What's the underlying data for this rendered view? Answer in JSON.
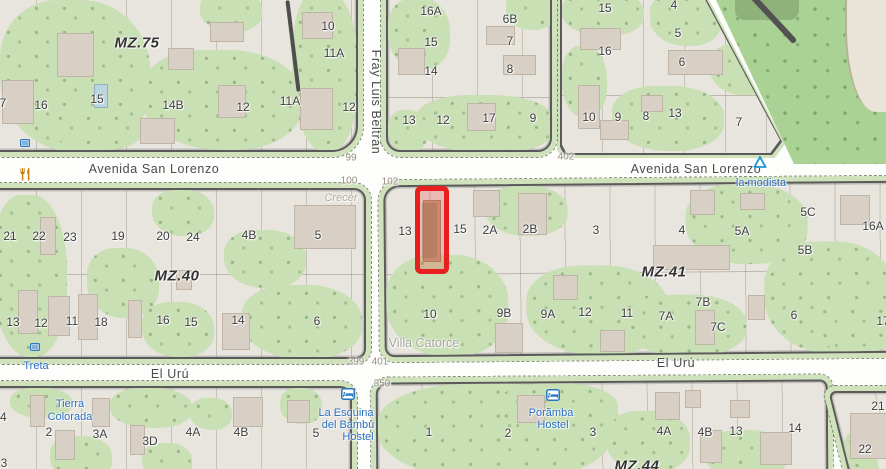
{
  "colors": {
    "highlight_red": "#e81f1f",
    "poi_blue": "#2a6fc0",
    "forest_green": "#abd295",
    "grass_green": "#c9dfb4",
    "block_base": "#e8e5de",
    "building": "#d9d0c5",
    "block_border": "#5a5a5a",
    "road_white": "#fdfdfb",
    "amenity_orange": "#c87d0e"
  },
  "map": {
    "mz_labels": [
      {
        "t": "MZ.75",
        "x": 137,
        "y": 43
      },
      {
        "t": "MZ.40",
        "x": 177,
        "y": 276
      },
      {
        "t": "MZ.41",
        "x": 664,
        "y": 272
      },
      {
        "t": "MZ.44",
        "x": 637,
        "y": 466
      }
    ],
    "street_labels": [
      {
        "t": "Avenida San Lorenzo",
        "x": 154,
        "y": 169
      },
      {
        "t": "Avenida San Lorenzo",
        "x": 696,
        "y": 169
      },
      {
        "t": "El Urú",
        "x": 170,
        "y": 374
      },
      {
        "t": "El Urú",
        "x": 676,
        "y": 363
      },
      {
        "t": "Fray Luis Beltrán",
        "x": 376,
        "y": 102,
        "vertical": true
      }
    ],
    "house_numbers": [
      {
        "t": "99",
        "x": 351,
        "y": 158
      },
      {
        "t": "100",
        "x": 349,
        "y": 181
      },
      {
        "t": "102",
        "x": 390,
        "y": 182
      },
      {
        "t": "402",
        "x": 566,
        "y": 157
      },
      {
        "t": "399",
        "x": 356,
        "y": 362
      },
      {
        "t": "401",
        "x": 380,
        "y": 362
      },
      {
        "t": "350",
        "x": 382,
        "y": 384
      }
    ],
    "lot_labels": [
      {
        "t": "10",
        "x": 328,
        "y": 26
      },
      {
        "t": "11A",
        "x": 334,
        "y": 53
      },
      {
        "t": "7",
        "x": 3,
        "y": 103
      },
      {
        "t": "16",
        "x": 41,
        "y": 105
      },
      {
        "t": "15",
        "x": 97,
        "y": 99
      },
      {
        "t": "14B",
        "x": 173,
        "y": 105
      },
      {
        "t": "12",
        "x": 243,
        "y": 107
      },
      {
        "t": "11A",
        "x": 290,
        "y": 101
      },
      {
        "t": "12",
        "x": 349,
        "y": 107
      },
      {
        "t": "16A",
        "x": 431,
        "y": 11
      },
      {
        "t": "6B",
        "x": 510,
        "y": 19
      },
      {
        "t": "15",
        "x": 431,
        "y": 42
      },
      {
        "t": "7",
        "x": 510,
        "y": 41
      },
      {
        "t": "14",
        "x": 431,
        "y": 71
      },
      {
        "t": "8",
        "x": 510,
        "y": 69
      },
      {
        "t": "13",
        "x": 409,
        "y": 120
      },
      {
        "t": "12",
        "x": 443,
        "y": 120
      },
      {
        "t": "17",
        "x": 489,
        "y": 118
      },
      {
        "t": "9",
        "x": 533,
        "y": 118
      },
      {
        "t": "15",
        "x": 605,
        "y": 8
      },
      {
        "t": "4",
        "x": 674,
        "y": 5
      },
      {
        "t": "5",
        "x": 678,
        "y": 33
      },
      {
        "t": "16",
        "x": 605,
        "y": 51
      },
      {
        "t": "6",
        "x": 682,
        "y": 62
      },
      {
        "t": "10",
        "x": 589,
        "y": 117
      },
      {
        "t": "9",
        "x": 618,
        "y": 117
      },
      {
        "t": "8",
        "x": 646,
        "y": 116
      },
      {
        "t": "13",
        "x": 675,
        "y": 113
      },
      {
        "t": "7",
        "x": 739,
        "y": 122
      },
      {
        "t": "21",
        "x": 10,
        "y": 236
      },
      {
        "t": "22",
        "x": 39,
        "y": 236
      },
      {
        "t": "23",
        "x": 70,
        "y": 237
      },
      {
        "t": "19",
        "x": 118,
        "y": 236
      },
      {
        "t": "20",
        "x": 163,
        "y": 236
      },
      {
        "t": "24",
        "x": 193,
        "y": 237
      },
      {
        "t": "4B",
        "x": 249,
        "y": 235
      },
      {
        "t": "5",
        "x": 318,
        "y": 235
      },
      {
        "t": "13",
        "x": 13,
        "y": 322
      },
      {
        "t": "12",
        "x": 41,
        "y": 323
      },
      {
        "t": "11",
        "x": 72,
        "y": 321
      },
      {
        "t": "18",
        "x": 101,
        "y": 322
      },
      {
        "t": "16",
        "x": 163,
        "y": 320
      },
      {
        "t": "15",
        "x": 191,
        "y": 322
      },
      {
        "t": "14",
        "x": 238,
        "y": 320
      },
      {
        "t": "6",
        "x": 317,
        "y": 321
      },
      {
        "t": "13",
        "x": 405,
        "y": 231
      },
      {
        "t": "15",
        "x": 460,
        "y": 229
      },
      {
        "t": "2A",
        "x": 490,
        "y": 230
      },
      {
        "t": "2B",
        "x": 530,
        "y": 229
      },
      {
        "t": "3",
        "x": 596,
        "y": 230
      },
      {
        "t": "4",
        "x": 682,
        "y": 230
      },
      {
        "t": "5A",
        "x": 742,
        "y": 231
      },
      {
        "t": "5C",
        "x": 808,
        "y": 212
      },
      {
        "t": "5B",
        "x": 805,
        "y": 250
      },
      {
        "t": "16A",
        "x": 873,
        "y": 226
      },
      {
        "t": "10",
        "x": 430,
        "y": 314
      },
      {
        "t": "9B",
        "x": 504,
        "y": 313
      },
      {
        "t": "9A",
        "x": 548,
        "y": 314
      },
      {
        "t": "12",
        "x": 585,
        "y": 312
      },
      {
        "t": "11",
        "x": 627,
        "y": 313
      },
      {
        "t": "7A",
        "x": 666,
        "y": 316
      },
      {
        "t": "7B",
        "x": 703,
        "y": 302
      },
      {
        "t": "7C",
        "x": 718,
        "y": 327
      },
      {
        "t": "6",
        "x": 794,
        "y": 315
      },
      {
        "t": "17",
        "x": 883,
        "y": 321
      },
      {
        "t": "24",
        "x": 0,
        "y": 417
      },
      {
        "t": "2",
        "x": 49,
        "y": 432
      },
      {
        "t": "3A",
        "x": 100,
        "y": 434
      },
      {
        "t": "3D",
        "x": 150,
        "y": 441
      },
      {
        "t": "4A",
        "x": 193,
        "y": 432
      },
      {
        "t": "4B",
        "x": 241,
        "y": 432
      },
      {
        "t": "5",
        "x": 316,
        "y": 433
      },
      {
        "t": "3",
        "x": 4,
        "y": 463
      },
      {
        "t": "1",
        "x": 429,
        "y": 432
      },
      {
        "t": "2",
        "x": 508,
        "y": 433
      },
      {
        "t": "3",
        "x": 593,
        "y": 432
      },
      {
        "t": "4A",
        "x": 664,
        "y": 431
      },
      {
        "t": "4B",
        "x": 705,
        "y": 432
      },
      {
        "t": "13",
        "x": 736,
        "y": 431
      },
      {
        "t": "14",
        "x": 795,
        "y": 428
      },
      {
        "t": "21",
        "x": 878,
        "y": 406
      },
      {
        "t": "22",
        "x": 865,
        "y": 449
      }
    ],
    "poi_labels": [
      {
        "t": "la modista",
        "x": 761,
        "y": 183
      },
      {
        "t": "Treta",
        "x": 36,
        "y": 366
      },
      {
        "t": "Tierra",
        "x": 70,
        "y": 404
      },
      {
        "t": "Colorada",
        "x": 70,
        "y": 417
      },
      {
        "t": "La Esquina",
        "x": 346,
        "y": 413
      },
      {
        "t": "del Bambú",
        "x": 348,
        "y": 425
      },
      {
        "t": "Hostel",
        "x": 358,
        "y": 437
      },
      {
        "t": "Porãmba",
        "x": 551,
        "y": 413
      },
      {
        "t": "Hostel",
        "x": 553,
        "y": 425
      }
    ],
    "place_labels": [
      {
        "t": "Crecer",
        "x": 341,
        "y": 198,
        "cls": ""
      },
      {
        "t": "Villa Catorce",
        "x": 424,
        "y": 343,
        "cls": "big"
      }
    ],
    "icons": [
      {
        "type": "restaurant",
        "x": 27,
        "y": 174
      },
      {
        "type": "viewpoint",
        "x": 760,
        "y": 162
      },
      {
        "type": "hostel",
        "x": 348,
        "y": 394
      },
      {
        "type": "hostel",
        "x": 553,
        "y": 395
      },
      {
        "type": "board",
        "x": 25,
        "y": 143
      },
      {
        "type": "board",
        "x": 35,
        "y": 347
      }
    ],
    "highlight": {
      "x": 415,
      "y": 186,
      "w": 34,
      "h": 88,
      "color": "#e81f1f"
    }
  }
}
